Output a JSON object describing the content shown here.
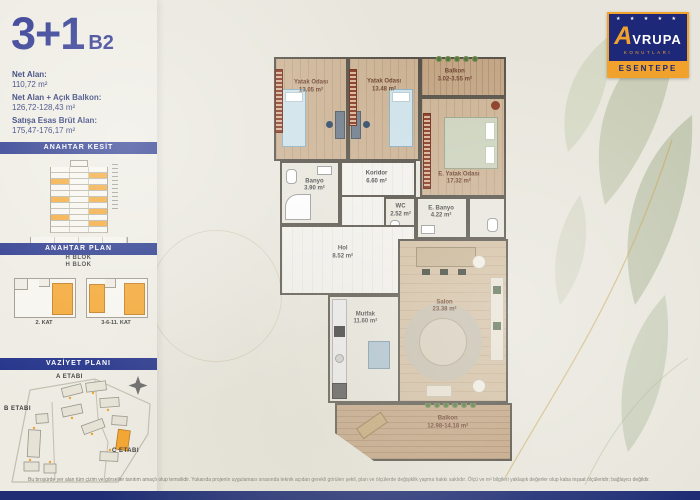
{
  "header": {
    "title": "3+1",
    "variant": "B2"
  },
  "areas": [
    {
      "label": "Net Alan:",
      "value": "110,72 m²"
    },
    {
      "label": "Net Alan + Açık Balkon:",
      "value": "126,72-128,43 m²"
    },
    {
      "label": "Satışa Esas Brüt Alan:",
      "value": "175,47-176,17 m²"
    }
  ],
  "sections": {
    "kesit_title": "ANAHTAR KESİT",
    "kesit_block": "H BLOK",
    "plan_title": "ANAHTAR PLAN",
    "plan_block": "H BLOK",
    "plan_floors": [
      "2. KAT",
      "3-6-11. KAT"
    ],
    "vaziyet_title": "VAZİYET PLANI",
    "etap_a": "A ETABI",
    "etap_b": "B ETABI",
    "etap_c": "C ETABI"
  },
  "logo": {
    "brand_a": "A",
    "brand_rest": "VRUPA",
    "brand_sub": "KONUTLARI",
    "project": "ESENTEPE"
  },
  "floorplan": {
    "rooms": [
      {
        "name": "Yatak Odası",
        "area": "13.05 m²"
      },
      {
        "name": "Yatak Odası",
        "area": "13.48 m²"
      },
      {
        "name": "Balkon",
        "area": "3.02-3.55 m²"
      },
      {
        "name": "E. Yatak Odası",
        "area": "17.32 m²"
      },
      {
        "name": "Banyo",
        "area": "3.90 m²"
      },
      {
        "name": "Koridor",
        "area": "6.60 m²"
      },
      {
        "name": "WC",
        "area": "2.52 m²"
      },
      {
        "name": "E. Banyo",
        "area": "4.22 m²"
      },
      {
        "name": "Hol",
        "area": "8.52 m²"
      },
      {
        "name": "Mutfak",
        "area": "11.60 m²"
      },
      {
        "name": "Salon",
        "area": "23.38 m²"
      },
      {
        "name": "Balkon",
        "area": "12.98-14.18 m²"
      }
    ]
  },
  "footer": {
    "disclaimer": "Bu broşürde yer alan tüm çizim ve görseller tanıtım amaçlı olup temsilidir. Yukarıda projenin uygulaması sırasında teknik açıdan gerekli görülen şekil, plan ve ölçülerde değişiklik yapma hakkı saklıdır. Ölçü ve m² bilgileri yaklaşık değerler olup kaba inşaat ölçüleridir; bağlayıcı değildir."
  }
}
